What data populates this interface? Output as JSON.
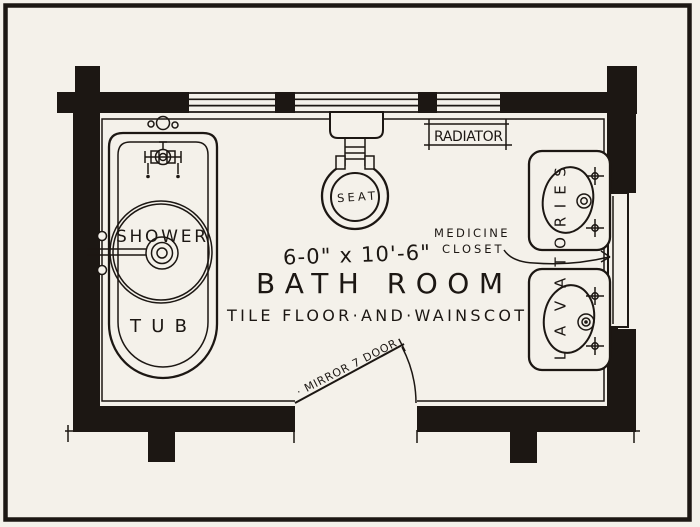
{
  "colors": {
    "paper": "#f4f1ea",
    "ink": "#1c1713"
  },
  "plan": {
    "dimensions_label": "6-0\" x 10'-6\"",
    "room_title": "BATH ROOM",
    "finish_note": "TILE FLOOR·AND·WAINSCOT",
    "fixtures": {
      "shower": "SHOWER",
      "tub": "TUB",
      "seat": "SEAT",
      "radiator": "RADIATOR",
      "medicine_closet_line1": "MEDICINE",
      "medicine_closet_line2": "CLOSET",
      "mirror_door": "· MIRROR 7 DOOR",
      "lavatories_word": "LAVATORIES",
      "lavatories_letters": [
        "L",
        "A",
        "V",
        "A",
        "T",
        "O",
        "R",
        "I",
        "E",
        "S"
      ]
    }
  }
}
